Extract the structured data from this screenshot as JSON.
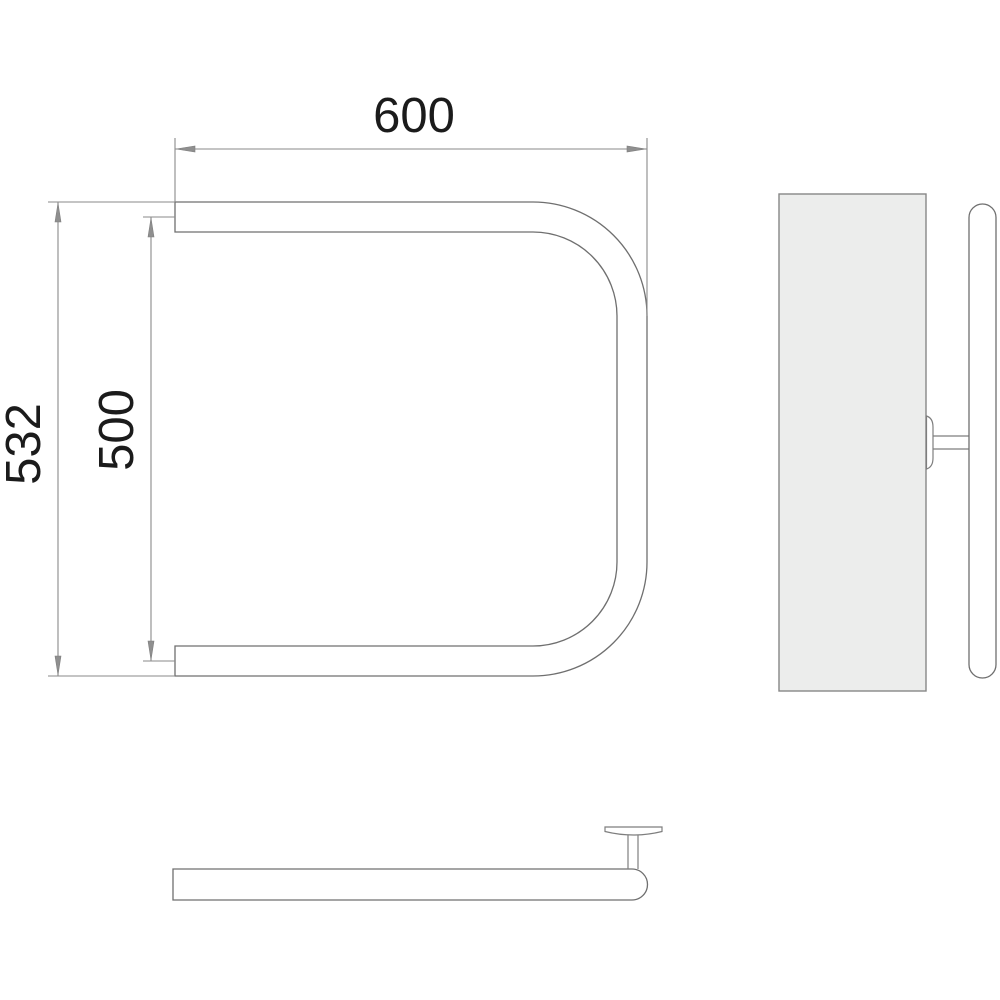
{
  "drawing": {
    "type": "technical-orthographic-drawing",
    "subject": "U-shaped towel rail (front, side and top views)",
    "dimensions": {
      "width_label": "600",
      "overall_height_label": "532",
      "tube_centers_height_label": "500"
    },
    "colors": {
      "background": "#ffffff",
      "line": "#7e7e7e",
      "tube_outline": "#6f6f6f",
      "wall_panel_fill": "#ecedec",
      "dimension_text": "#1b1b1b"
    }
  }
}
